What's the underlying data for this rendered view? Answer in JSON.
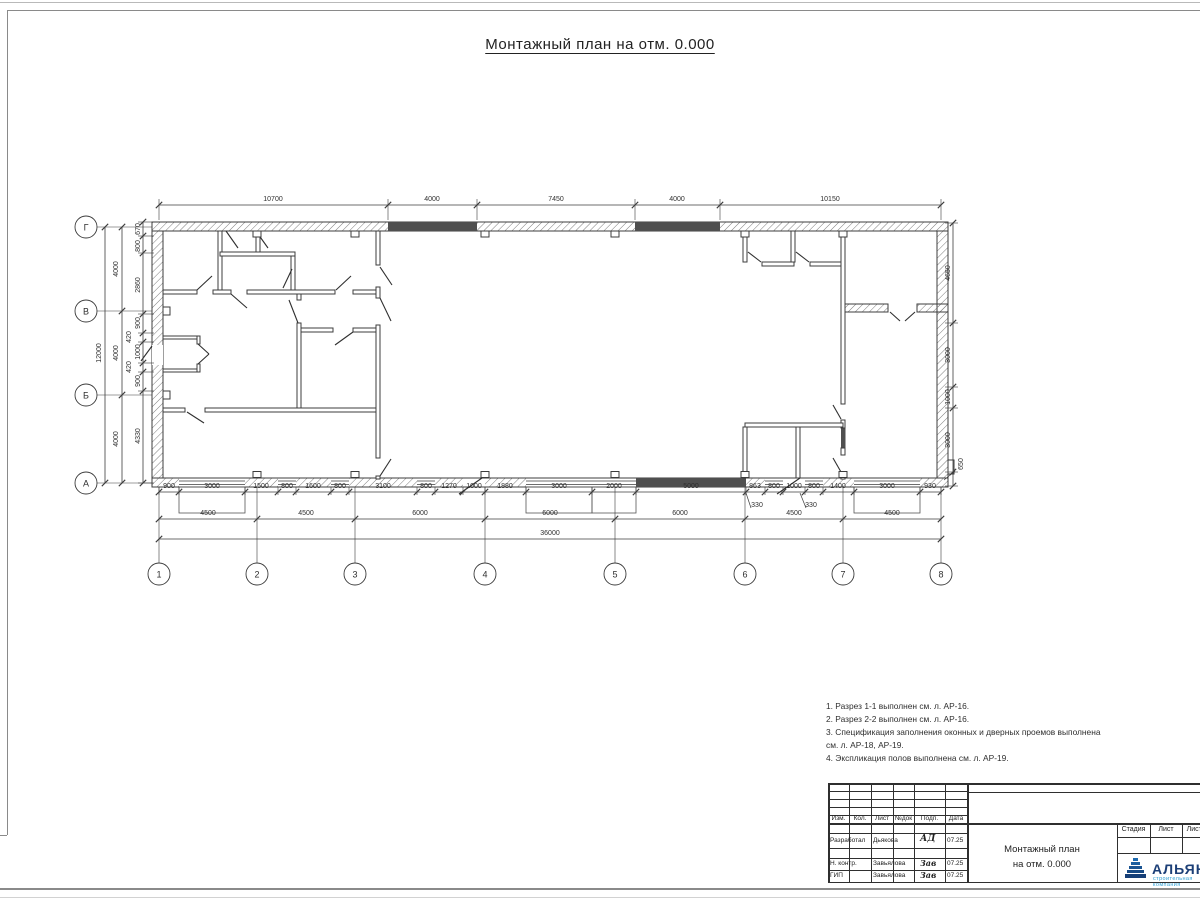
{
  "page": {
    "title": "Монтажный план на отм. 0.000"
  },
  "axes": {
    "h": [
      "1",
      "2",
      "3",
      "4",
      "5",
      "6",
      "7",
      "8"
    ],
    "v": [
      "Г",
      "В",
      "Б",
      "А"
    ]
  },
  "dims": {
    "top": [
      "10700",
      "4000",
      "7450",
      "4000",
      "10150"
    ],
    "b1": [
      "900",
      "3000",
      "1500",
      "800",
      "1600",
      "800",
      "3100",
      "800",
      "1270",
      "1000",
      "1880",
      "3000",
      "2000",
      "5000",
      "863",
      "800",
      "1000",
      "800",
      "1400",
      "3000",
      "930"
    ],
    "b2": [
      "4500",
      "4500",
      "6000",
      "6000",
      "6000",
      "4500",
      "4500"
    ],
    "total": "36000",
    "off1": "330",
    "off2": "330",
    "louter": "12000",
    "lmid": [
      "4000",
      "4000",
      "4000"
    ],
    "linner": [
      "670",
      "800",
      "2860",
      "900",
      "420",
      "1000",
      "420",
      "900",
      "4330"
    ],
    "right": [
      "4650",
      "3000",
      "1000",
      "3000",
      "650"
    ]
  },
  "notes": [
    "1. Разрез 1-1 выполнен см. л. АР-16.",
    "2. Разрез 2-2 выполнен см. л. АР-16.",
    "3. Спецификация заполнения оконных и дверных проемов выполнена",
    "см. л. АР-18, АР-19.",
    "4. Экспликация полов выполнена см. л. АР-19."
  ],
  "tb": {
    "header": [
      "Изм.",
      "Кол.",
      "Лист",
      "№док",
      "Подп.",
      "Дата"
    ],
    "rows": [
      {
        "label": "Разработал",
        "name": "Дьякова",
        "sig": "АД",
        "date": "07.25"
      },
      {
        "label": "Н. контр.",
        "name": "Завьялова",
        "sig": "Зав",
        "date": "07.25"
      },
      {
        "label": "ГИП",
        "name": "Завьялова",
        "sig": "Зав",
        "date": "07.25"
      }
    ],
    "doc1": "Монтажный план",
    "doc2": "на отм. 0.000",
    "stage": [
      "Стадия",
      "Лист",
      "Листов"
    ],
    "brand": "АЛЬЯНС",
    "brand_sub": "строительная компания",
    "accent": "#1c3f77",
    "accent_light": "#2e9fd4"
  }
}
